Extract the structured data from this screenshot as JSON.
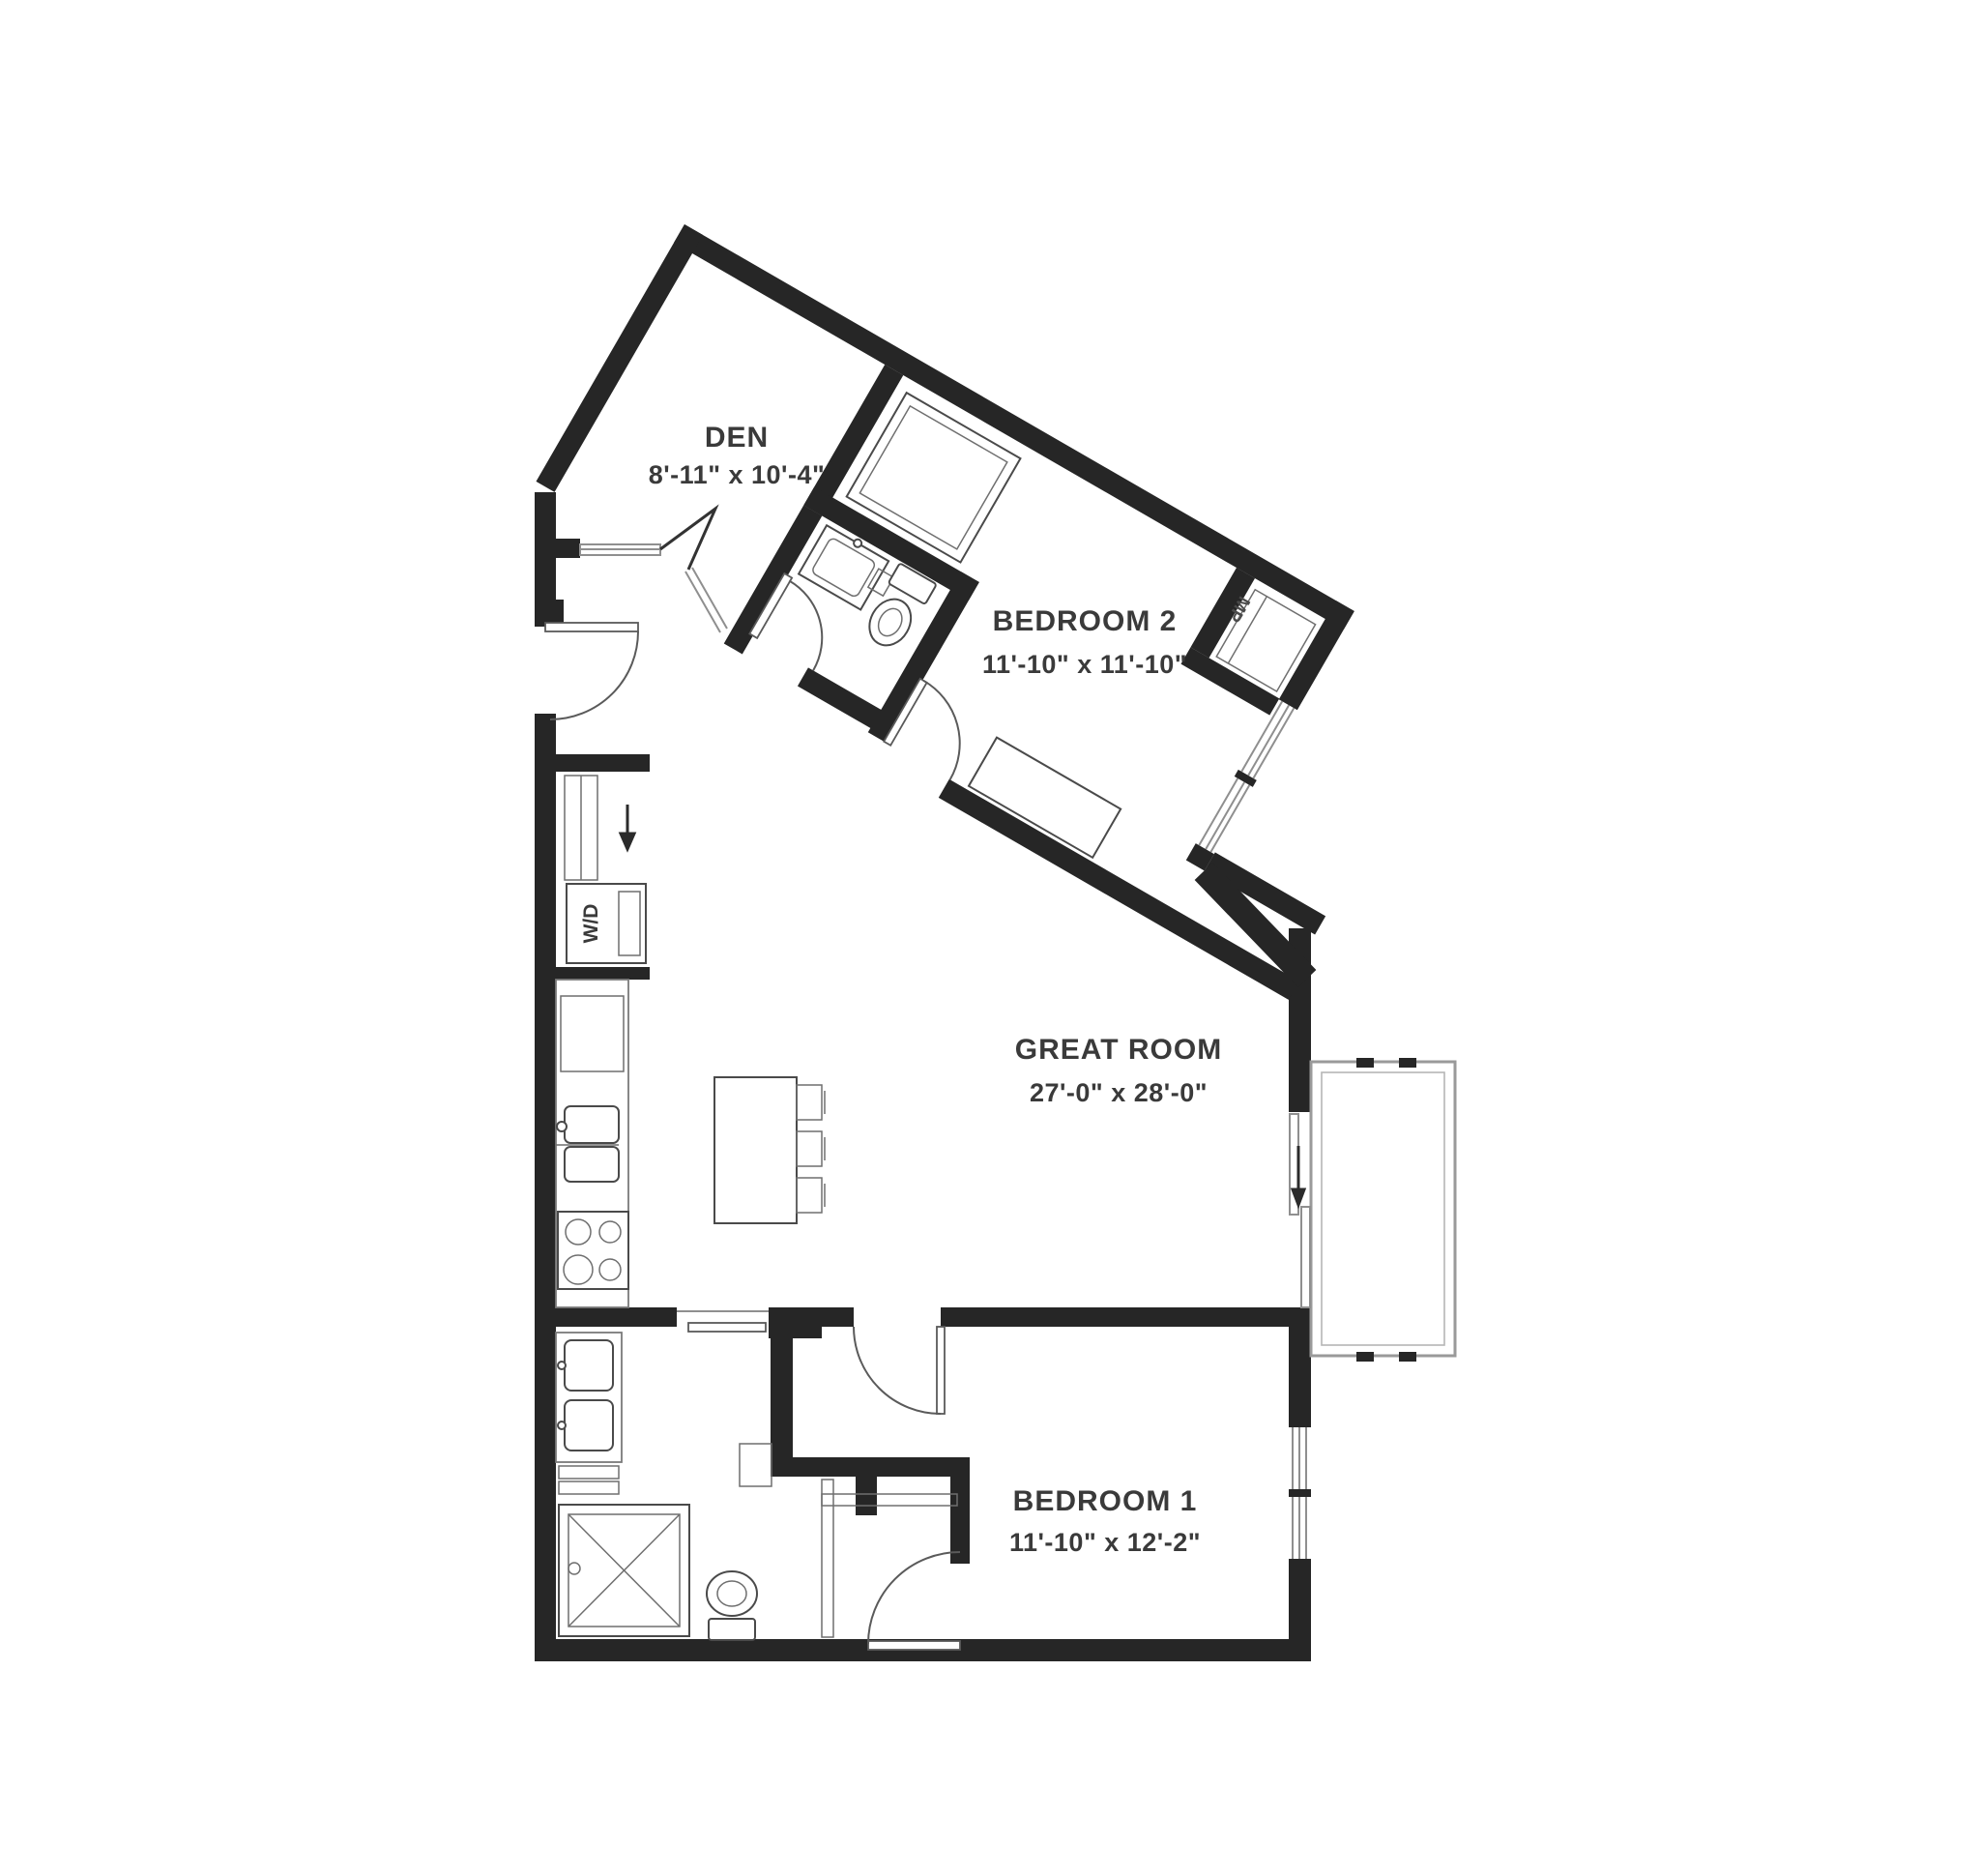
{
  "plan": {
    "type": "apartment-floor-plan",
    "rooms": {
      "den": {
        "name": "DEN",
        "dims": "8'-11\" x 10'-4\""
      },
      "bedroom2": {
        "name": "BEDROOM 2",
        "dims": "11'-10\" x 11'-10\""
      },
      "great_room": {
        "name": "GREAT ROOM",
        "dims": "27'-0\" x 28'-0\""
      },
      "bedroom1": {
        "name": "BEDROOM 1",
        "dims": "11'-10\" x 12'-2\""
      }
    },
    "labels": {
      "washer_dryer": "W/D",
      "bedroom2_closet": "MP"
    },
    "colors": {
      "wall": "#262626",
      "fixture_stroke": "#4a4a4a",
      "window_stroke": "#8f8f8f",
      "text": "#3a3a3a",
      "background": "#ffffff"
    }
  }
}
